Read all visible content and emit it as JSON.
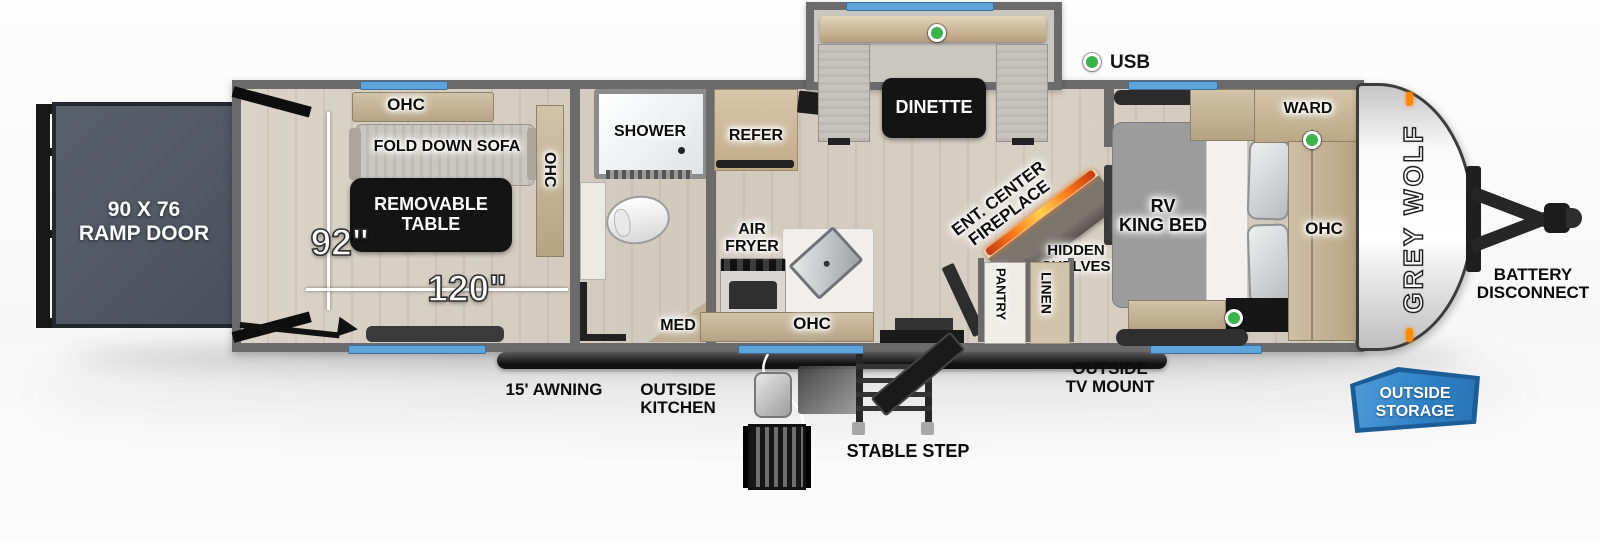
{
  "title": "Grey Wolf toy hauler travel trailer floorplan",
  "colors": {
    "wall_gray": "#6b6b6b",
    "window_blue": "#5ea4da",
    "usb_green": "#3bb24a",
    "storage_blue": "#2e7fc4",
    "fireplace_orange": "#ff7a1a",
    "ramp_slate": "#59616d",
    "floor_wood": "#d7cfc2",
    "cabinet_tan": "#c4b396"
  },
  "ramp": {
    "line1": "90 X 76",
    "line2": "RAMP DOOR"
  },
  "garage": {
    "ohc_top": "OHC",
    "sofa": "FOLD DOWN SOFA",
    "table": {
      "line1": "REMOVABLE",
      "line2": "TABLE"
    },
    "ohc_side": "OHC",
    "dim_height": "92\"",
    "dim_length": "120\""
  },
  "bath": {
    "shower": "SHOWER",
    "med": "MED"
  },
  "kitchen": {
    "refer": "REFER",
    "air_fryer": {
      "line1": "AIR",
      "line2": "FRYER"
    },
    "ohc": "OHC"
  },
  "living": {
    "dinette": "DINETTE",
    "ent_center": {
      "line1": "ENT. CENTER",
      "line2": "FIREPLACE"
    },
    "hidden_shelves": {
      "line1": "HIDDEN",
      "line2": "SHELVES"
    },
    "pantry": "PANTRY",
    "linen": "LINEN"
  },
  "legend": {
    "usb": "USB"
  },
  "bedroom": {
    "bed": {
      "line1": "RV",
      "line2": "KING BED"
    },
    "ward": "WARD",
    "ohc": "OHC"
  },
  "exterior": {
    "brand": "GREY WOLF",
    "battery": {
      "line1": "BATTERY",
      "line2": "DISCONNECT"
    },
    "storage": {
      "line1": "OUTSIDE",
      "line2": "STORAGE"
    },
    "awning": "15' AWNING",
    "outside_kitchen": {
      "line1": "OUTSIDE",
      "line2": "KITCHEN"
    },
    "stable_step": "STABLE STEP",
    "tv_mount": {
      "line1": "OUTSIDE",
      "line2": "TV MOUNT"
    }
  }
}
